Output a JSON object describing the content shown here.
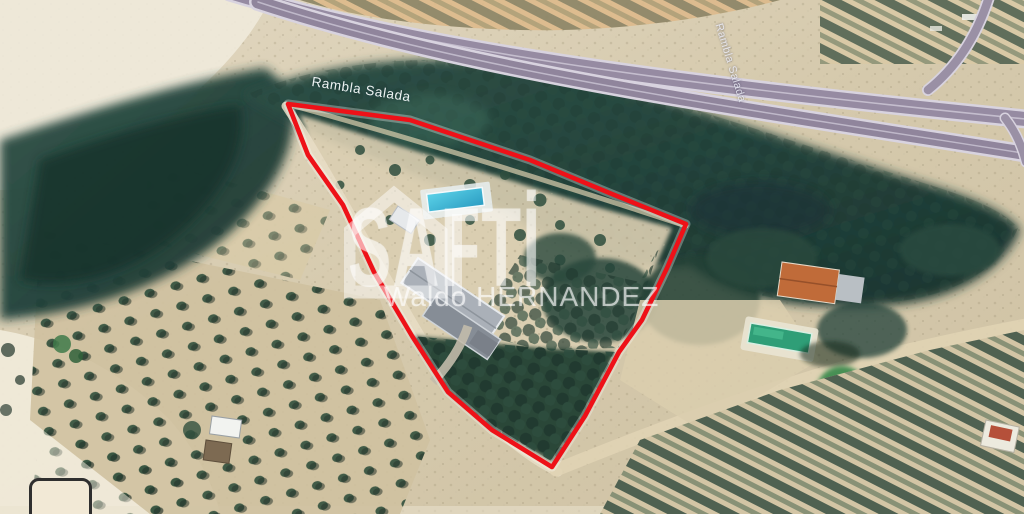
{
  "view": {
    "type": "aerial-satellite-photo",
    "width_px": 1024,
    "height_px": 514,
    "description": "Google-Earth style aerial view of a rural property for sale with red boundary outline"
  },
  "labels": {
    "stream_label": "Rambla Salada",
    "road_label": "Rambla Salada"
  },
  "watermark": {
    "brand": "SAFTI",
    "brand_display": "SAFTİ",
    "agent": "Waldo HERNANDEZ",
    "icon": "house-icon",
    "text_color": "#ffffff"
  },
  "parcel": {
    "outline_color": "#ee1118",
    "vertices_px": [
      [
        288,
        104
      ],
      [
        410,
        120
      ],
      [
        530,
        160
      ],
      [
        612,
        194
      ],
      [
        686,
        224
      ],
      [
        667,
        268
      ],
      [
        642,
        320
      ],
      [
        619,
        352
      ],
      [
        585,
        416
      ],
      [
        552,
        467
      ],
      [
        492,
        430
      ],
      [
        448,
        392
      ],
      [
        412,
        336
      ],
      [
        374,
        272
      ],
      [
        343,
        205
      ],
      [
        308,
        155
      ]
    ]
  },
  "map_features": {
    "terrain_color": "#d5c9ae",
    "pale_ground_color": "#efe9da",
    "vegetation_color": "#24413c",
    "highway_color": "#978da3",
    "parcel_pool_color": "#4cc8e0",
    "neighbor_pool_color": "#2f9e77",
    "neighbor_roof_color": "#c0693a",
    "features": [
      "divided-highway-top",
      "highway-ramp-top-right",
      "dense-rambla-vegetation-band",
      "olive-grove-grid-left",
      "parcel-house-gray-roofs",
      "parcel-swimming-pool",
      "parcel-dense-orchard",
      "neighbor-house-orange-roof",
      "neighbor-green-pool",
      "tree-rows-bottom-right",
      "white-shed-and-brown-shed-left",
      "cropped-rounded-box-bottom-left"
    ]
  }
}
